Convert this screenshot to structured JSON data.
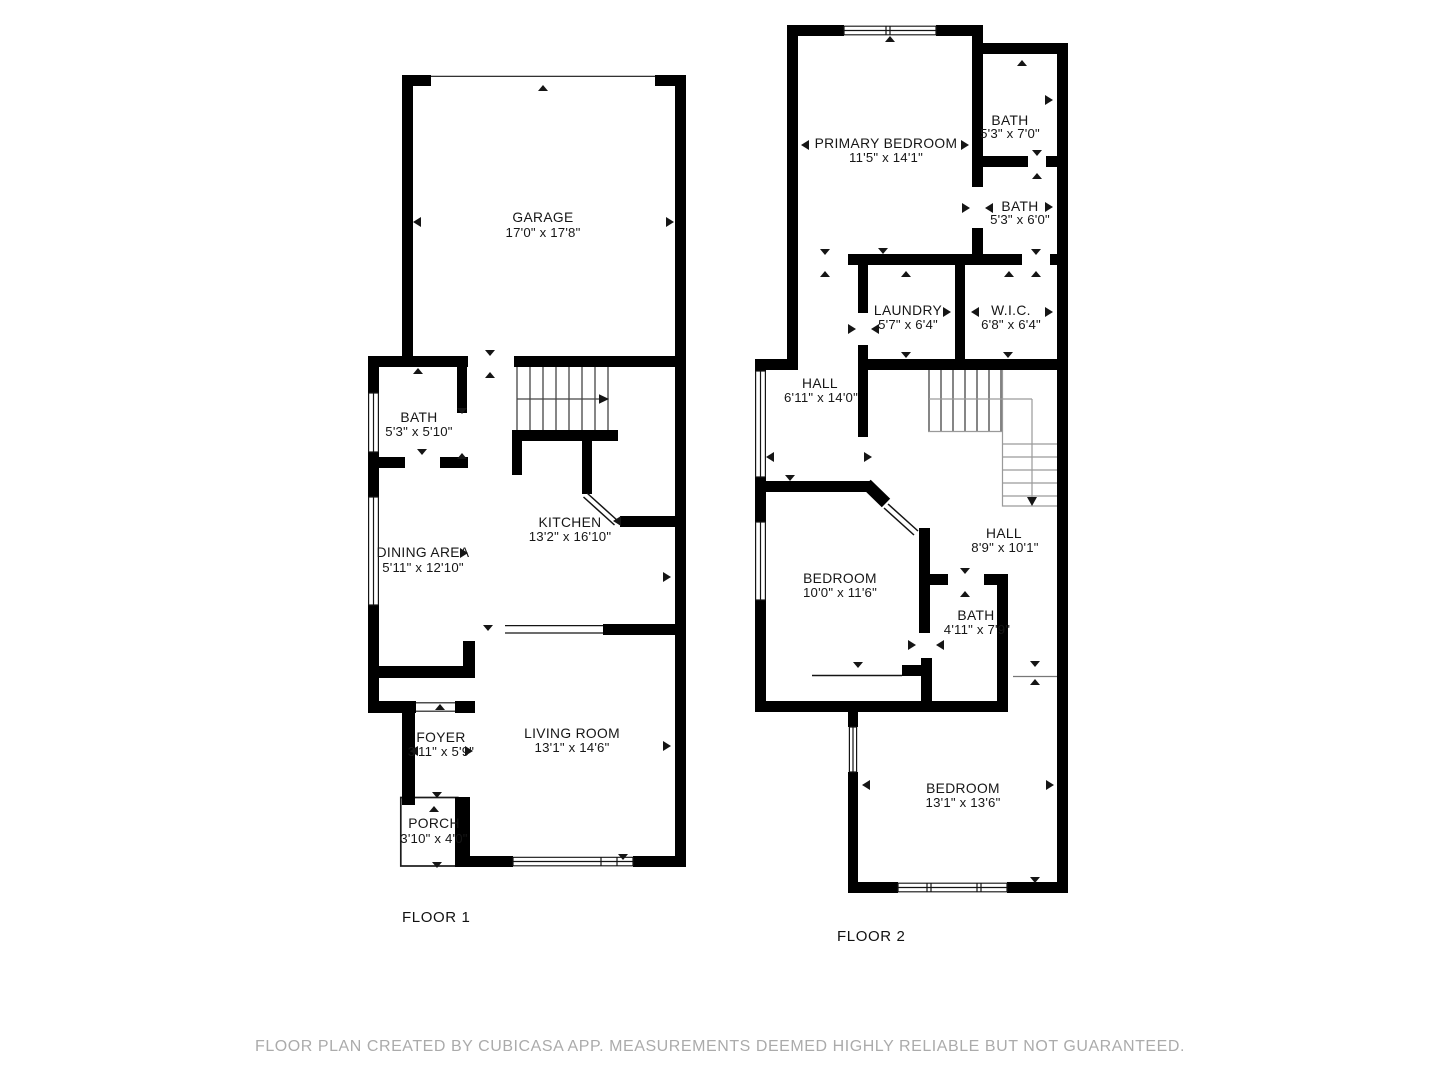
{
  "floor1": {
    "label": "FLOOR 1",
    "rooms": [
      {
        "id": "garage",
        "name": "GARAGE",
        "dims": "17'0\" x 17'8\""
      },
      {
        "id": "bath",
        "name": "BATH",
        "dims": "5'3\" x 5'10\""
      },
      {
        "id": "kitchen",
        "name": "KITCHEN",
        "dims": "13'2\" x 16'10\""
      },
      {
        "id": "dining-area",
        "name": "DINING AREA",
        "dims": "5'11\" x 12'10\""
      },
      {
        "id": "foyer",
        "name": "FOYER",
        "dims": "3'11\" x 5'9\""
      },
      {
        "id": "living-room",
        "name": "LIVING ROOM",
        "dims": "13'1\" x 14'6\""
      },
      {
        "id": "porch",
        "name": "PORCH",
        "dims": "3'10\" x 4'0\""
      }
    ]
  },
  "floor2": {
    "label": "FLOOR 2",
    "rooms": [
      {
        "id": "primary-bedroom",
        "name": "PRIMARY BEDROOM",
        "dims": "11'5\" x 14'1\""
      },
      {
        "id": "bath-upper",
        "name": "BATH",
        "dims": "5'3\" x 7'0\""
      },
      {
        "id": "bath-middle",
        "name": "BATH",
        "dims": "5'3\" x 6'0\""
      },
      {
        "id": "laundry",
        "name": "LAUNDRY",
        "dims": "5'7\" x 6'4\""
      },
      {
        "id": "wic",
        "name": "W.I.C.",
        "dims": "6'8\" x 6'4\""
      },
      {
        "id": "hall-upper",
        "name": "HALL",
        "dims": "6'11\" x 14'0\""
      },
      {
        "id": "bedroom-middle",
        "name": "BEDROOM",
        "dims": "10'0\" x 11'6\""
      },
      {
        "id": "hall-lower",
        "name": "HALL",
        "dims": "8'9\" x 10'1\""
      },
      {
        "id": "bath-lower",
        "name": "BATH",
        "dims": "4'11\" x 7'9\""
      },
      {
        "id": "bedroom-bottom",
        "name": "BEDROOM",
        "dims": "13'1\" x 13'6\""
      }
    ]
  },
  "footer": {
    "text": "FLOOR PLAN CREATED BY CUBICASA APP. MEASUREMENTS DEEMED HIGHLY RELIABLE BUT NOT GUARANTEED."
  },
  "colors": {
    "wall": "#000000",
    "label_text": "#161616",
    "footer_text": "#ababab",
    "stair_dark": "#454545",
    "stair_light": "#9a9a9a"
  }
}
